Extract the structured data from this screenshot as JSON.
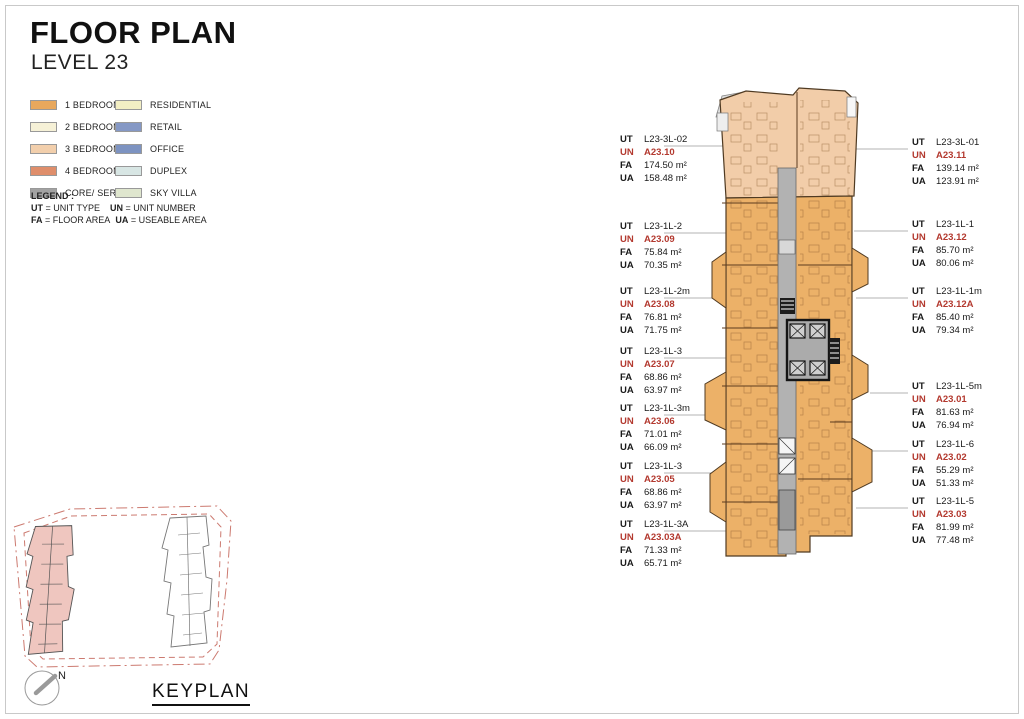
{
  "page": {
    "title": "FLOOR PLAN",
    "subtitle": "LEVEL 23"
  },
  "legend": {
    "items_col1": [
      {
        "label": "1 BEDROOM",
        "color": "#E8A85D"
      },
      {
        "label": "2 BEDROOM",
        "color": "#F6F1D7"
      },
      {
        "label": "3 BEDROOM",
        "color": "#F2CFAC"
      },
      {
        "label": "4 BEDROOM",
        "color": "#DF8E6B"
      },
      {
        "label": "CORE/ SERVICE",
        "color": "#A2A2A2"
      }
    ],
    "items_col2": [
      {
        "label": "RESIDENTIAL",
        "color": "#F3EFC4"
      },
      {
        "label": "RETAIL",
        "color": "#8598C5"
      },
      {
        "label": "OFFICE",
        "color": "#7D93C1"
      },
      {
        "label": "DUPLEX",
        "color": "#D8E6E4"
      },
      {
        "label": "SKY VILLA",
        "color": "#DFE6CE"
      }
    ],
    "note_title": "LEGEND :",
    "notes": [
      {
        "key": "UT",
        "text": "= UNIT TYPE"
      },
      {
        "key": "UN",
        "text": "= UNIT NUMBER"
      },
      {
        "key": "FA",
        "text": "= FLOOR AREA"
      },
      {
        "key": "UA",
        "text": "= USEABLE AREA"
      }
    ]
  },
  "label_prefixes": {
    "ut": "UT",
    "un": "UN",
    "fa": "FA",
    "ua": "UA"
  },
  "units_left": [
    {
      "ut": "L23-3L-02",
      "un": "A23.10",
      "fa": "174.50 m²",
      "ua": "158.48 m²"
    },
    {
      "ut": "L23-1L-2",
      "un": "A23.09",
      "fa": "75.84 m²",
      "ua": "70.35 m²"
    },
    {
      "ut": "L23-1L-2m",
      "un": "A23.08",
      "fa": "76.81 m²",
      "ua": "71.75 m²"
    },
    {
      "ut": "L23-1L-3",
      "un": "A23.07",
      "fa": "68.86 m²",
      "ua": "63.97 m²"
    },
    {
      "ut": "L23-1L-3m",
      "un": "A23.06",
      "fa": "71.01 m²",
      "ua": "66.09 m²"
    },
    {
      "ut": "L23-1L-3",
      "un": "A23.05",
      "fa": "68.86 m²",
      "ua": "63.97 m²"
    },
    {
      "ut": "L23-1L-3A",
      "un": "A23.03A",
      "fa": "71.33 m²",
      "ua": "65.71 m²"
    }
  ],
  "units_right": [
    {
      "ut": "L23-3L-01",
      "un": "A23.11",
      "fa": "139.14 m²",
      "ua": "123.91 m²"
    },
    {
      "ut": "L23-1L-1",
      "un": "A23.12",
      "fa": "85.70 m²",
      "ua": "80.06 m²"
    },
    {
      "ut": "L23-1L-1m",
      "un": "A23.12A",
      "fa": "85.40 m²",
      "ua": "79.34 m²"
    },
    {
      "ut": "L23-1L-5m",
      "un": "A23.01",
      "fa": "81.63 m²",
      "ua": "76.94 m²"
    },
    {
      "ut": "L23-1L-6",
      "un": "A23.02",
      "fa": "55.29 m²",
      "ua": "51.33 m²"
    },
    {
      "ut": "L23-1L-5",
      "un": "A23.03",
      "fa": "81.99 m²",
      "ua": "77.48 m²"
    }
  ],
  "keyplan": {
    "title": "KEYPLAN",
    "north_label": "N"
  },
  "colors": {
    "unit_number_red": "#B3392F",
    "plan_orange": "#ECB168",
    "plan_peach": "#F2CDA9",
    "core_gray": "#ABABAB",
    "keyplan_highlight": "#EFC6BF"
  }
}
